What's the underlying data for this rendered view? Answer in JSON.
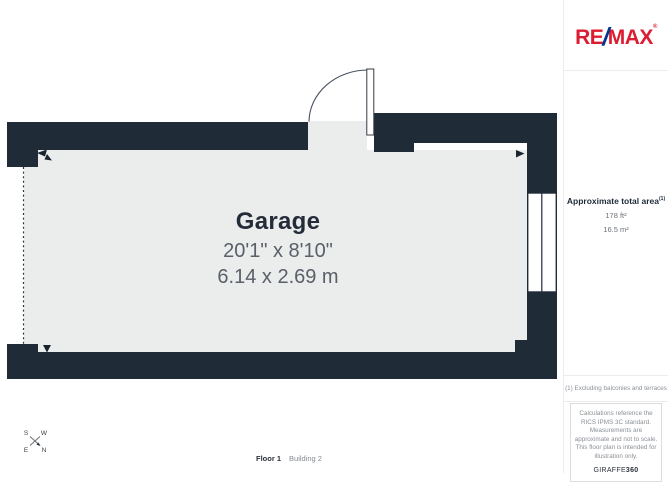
{
  "plan": {
    "room_label": "Garage",
    "dims_imperial": "20'1\" x 8'10\"",
    "dims_metric": "6.14 x 2.69 m",
    "floor_label": "Floor 1",
    "building_label": "Building 2",
    "compass": {
      "nw": "S",
      "ne": "W",
      "sw": "E",
      "se": "N"
    }
  },
  "sidebar": {
    "logo": {
      "part1": "RE",
      "slash": "/",
      "part2": "MAX",
      "registered": "®"
    },
    "area": {
      "title": "Approximate total area",
      "note_ref": "(1)",
      "imperial": "178 ft²",
      "metric": "16.5 m²"
    },
    "footnote": "(1) Excluding balconies and terraces",
    "disclaimer": "Calculations reference the RICS IPMS 3C standard. Measurements are approximate and not to scale. This floor plan is intended for illustration only.",
    "credit": {
      "brand": "GIRAFFE",
      "brand_bold": "360"
    }
  },
  "colors": {
    "wall": "#202b38",
    "floor": "#ebecec",
    "remax_red": "#dc1d31",
    "remax_blue": "#00388c",
    "text_dark": "#232c38",
    "text_gray": "#5a6068"
  }
}
